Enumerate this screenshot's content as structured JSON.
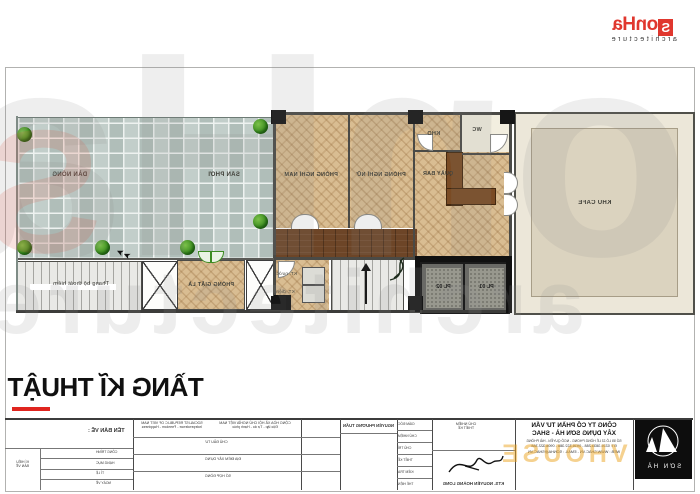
{
  "brand": {
    "logo_s": "S",
    "logo_rest": "onHa",
    "logo_sub": "architecture",
    "accent_red": "#e0372e"
  },
  "watermark": {
    "big": "SonHa",
    "sub": "architecture",
    "left_s": "S",
    "overlay": "VHOUSE"
  },
  "sheet": {
    "title": "TẦNG KĨ THUẬT"
  },
  "plan": {
    "labels": {
      "dan_nong": "DÀN NÓNG",
      "san_phoi": "SÂN PHƠI",
      "thang_bo": "Thang bộ thoát hiểm",
      "phong_giat_la": "PHÒNG GIẶT LÀ",
      "phong_nghi_nam": "PHÒNG NGHỈ NAM",
      "phong_nghi_nu": "PHÒNG NGHỈ NỮ",
      "quay_bar": "QUẦY BAR",
      "kho": "KHO",
      "wc": "WC",
      "khu_cafe": "KHU CAFE",
      "pl_01": "PL 01",
      "pl_02": "PL 02",
      "kt_nuoc": "KT. nước",
      "kt_dien": "KT. điện"
    }
  },
  "titleblock": {
    "ten_ban_ve": "TÊN BẢN VẼ :",
    "ki_hieu_1": "KÍ HIỆU",
    "ki_hieu_2": "BẢN VẼ",
    "rows_left": [
      "CÔNG TRÌNH",
      "HẠNG MỤC",
      "TỈ LỆ",
      "NGÀY VẼ"
    ],
    "motto_en_1": "SOCIALIST REPUBLIC OF VIET NAM",
    "motto_en_2": "Independence - Freedom - Happiness",
    "motto_vi_1": "CỘNG HÒA XÃ HỘI CHỦ NGHĨA VIỆT NAM",
    "motto_vi_2": "Độc lập - Tự do - Hạnh phúc",
    "rows_mid": [
      "CHỦ ĐẦU TƯ",
      "ĐỊA ĐIỂM XÂY DỰNG",
      "SỐ HỢP ĐỒNG"
    ],
    "client_name": "NGUYỄN PHƯƠNG TUẤN",
    "rows_sign": [
      "GIÁM ĐỐC",
      "CHỦ NHIỆM",
      "CHỦ TRÌ",
      "THIẾT KẾ",
      "KIỂM TRA",
      "THỂ HIỆN"
    ],
    "sign_head_1": "CHỦ NHIỆM",
    "sign_head_2": "THIẾT KẾ",
    "architect": "KTS. NGUYỄN HOÀNG LONG",
    "company": {
      "name_1": "CÔNG TY CỔ PHẦN TƯ VẤN",
      "name_2": "XÂY DỰNG SƠN HÀ - SHAC",
      "address": "SỐ 55 LÔ 22 LÊ HỒNG PHONG - NGÔ QUYỀN - HẢI PHÒNG",
      "phone": "ĐT: 0225.3833.288 - 0916.322.388 - 0906.322.388",
      "web": "WEB : WWW.SHAC.VN - EMAIL : SONHA@SHAC.VN",
      "logo_caption": "SƠN HÀ"
    }
  }
}
